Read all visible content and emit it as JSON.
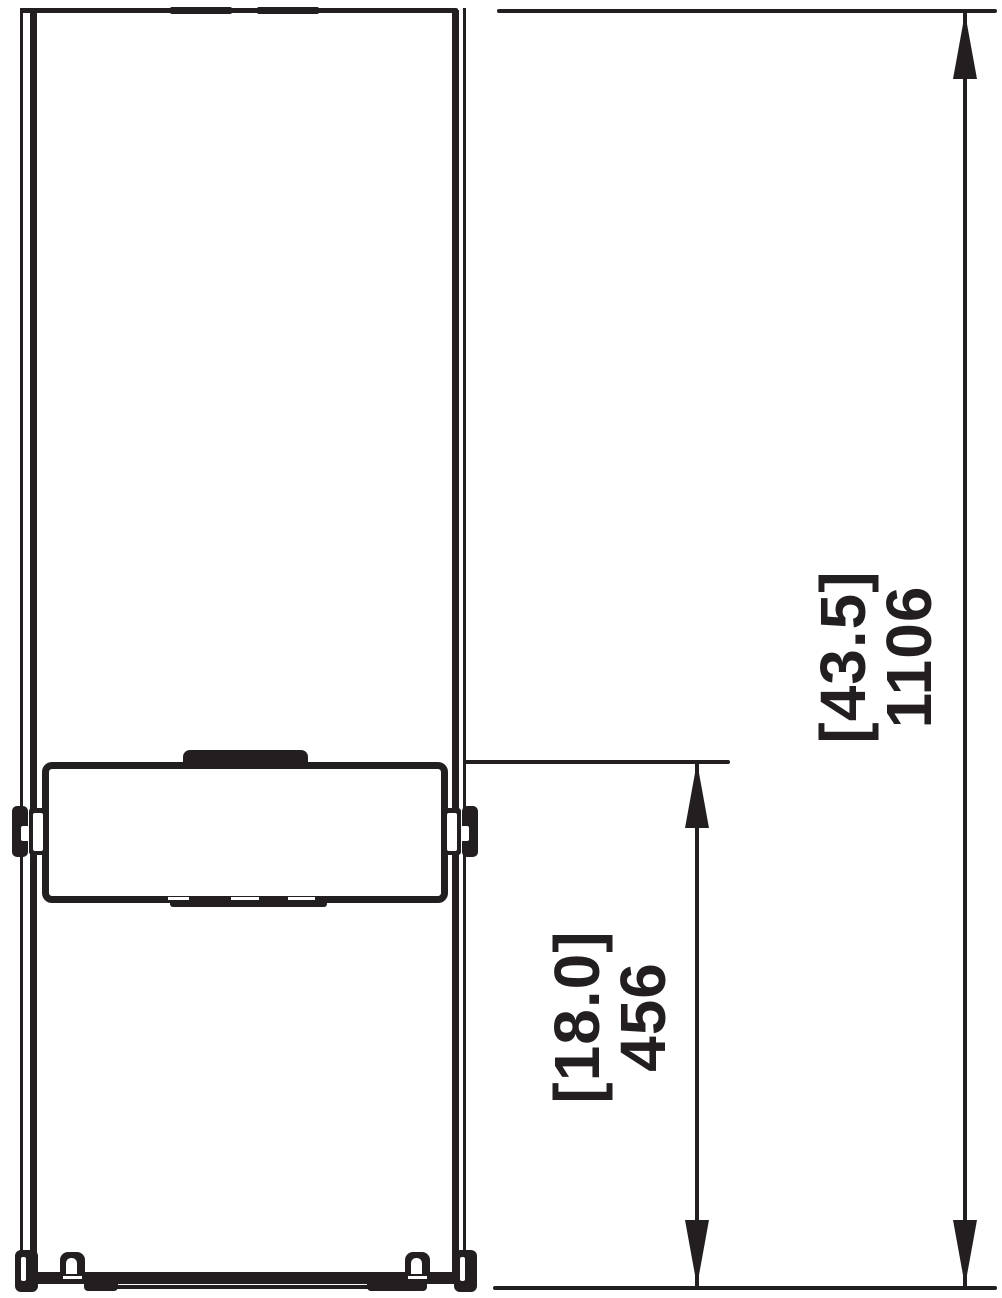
{
  "dimensions": {
    "overall": {
      "imperial": "[43.5]",
      "metric": "1106"
    },
    "firebox": {
      "imperial": "[18.0]",
      "metric": "456"
    }
  },
  "colors": {
    "line": "#231f20",
    "background": "#ffffff"
  }
}
